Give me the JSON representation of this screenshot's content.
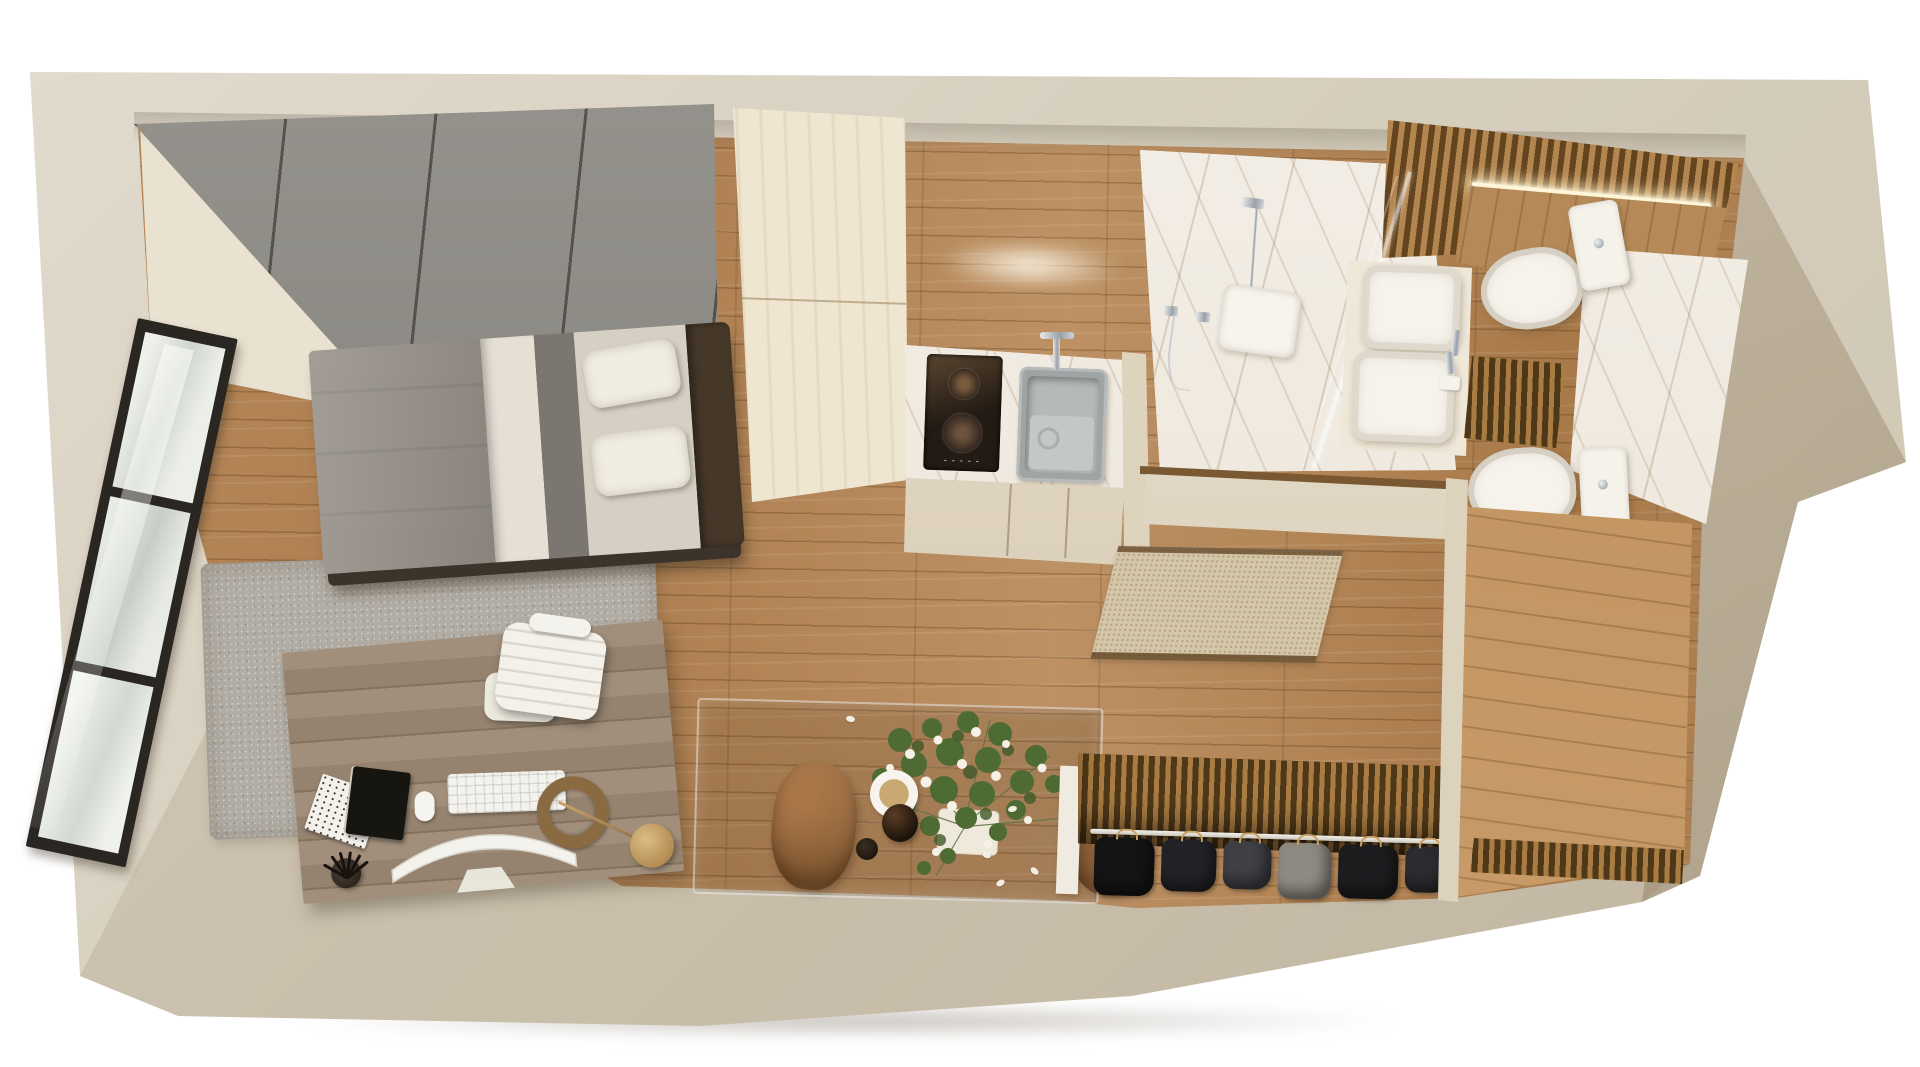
{
  "title": "Top-view 3D render of a studio apartment floor plan",
  "scene": {
    "type": "3d-floorplan-top-view",
    "apartment_label": "Studio apartment",
    "rooms": [
      {
        "name": "sleeping-work-area",
        "label": "Sleeping and work area",
        "items": [
          "grey wardrobe panels",
          "single bed with grey bedding",
          "area rug",
          "desk with computer, keyboard, notebooks, pens and lamp",
          "white office chair",
          "black-framed floor window"
        ]
      },
      {
        "name": "kitchenette",
        "label": "Kitchenette",
        "items": [
          "tall light-wood cabinet column",
          "two-zone induction hob",
          "grey square sink with chrome faucet",
          "marble countertop",
          "base cabinets",
          "under-cabinet light"
        ]
      },
      {
        "name": "hall-dining",
        "label": "Hall and dining corner",
        "items": [
          "glass dining table",
          "two tan chairs",
          "flower bouquet in white planter",
          "coffee mug",
          "dark bottle",
          "small cup",
          "entry doormat"
        ]
      },
      {
        "name": "bathroom",
        "label": "Bathroom",
        "items": [
          "marble walk-in shower",
          "ceiling rain shower",
          "hand shower",
          "glass partition",
          "square basin vanity",
          "two toilets (with mirror reflection)",
          "wood slat accent wall",
          "LED strip light"
        ]
      },
      {
        "name": "entry-closet",
        "label": "Open entry closet",
        "items": [
          "wood slat back panel",
          "hanging rail",
          "dark hanging clothes",
          "wood closet floor"
        ]
      }
    ],
    "labels": {
      "building": "Apartment outer walls",
      "floor": "Oak plank flooring",
      "window": "Black framed window",
      "wardrobe": "Built-in grey wardrobe",
      "bed": "Single bed",
      "headboard": "Dark wood headboard",
      "rug": "Grey area rug",
      "desk": "Wooden work desk",
      "imac": "All-in-one computer",
      "keyboard": "Keyboard",
      "mouse": "Mouse",
      "notebook_black": "Black notebook",
      "notebook_white": "Magazine",
      "pens": "Pen cup",
      "lamp": "Brass desk lamp",
      "desk_chair": "White office chair",
      "tall_cabinet": "Tall kitchen cabinet",
      "cooktop": "Induction hob",
      "sink": "Kitchen sink",
      "counter": "Marble counter",
      "cabinets": "Kitchen base cabinets",
      "glow": "Under-cabinet light",
      "shower_floor": "Marble shower area",
      "rain_shower": "Rain shower head",
      "hand_shower": "Hand shower",
      "glass_partition": "Glass shower partition",
      "slat_wall": "Wood slat accent wall",
      "led": "LED strip light",
      "wood_panel": "Wood wall panel",
      "marble_wall": "Marble wall",
      "vanity": "Bathroom vanity",
      "basin": "Square wash basin",
      "toilet": "Toilet",
      "slat_floor": "Slatted wood floor insert",
      "partition": "Bathroom partition wall",
      "threshold": "Wood threshold",
      "doormat": "Entry doormat",
      "table": "Glass dining table",
      "chair_tan_left": "Tan dining chair",
      "chair_tan_right": "Tan dining chair",
      "bouquet": "Flower bouquet",
      "mug": "Coffee mug",
      "bottle": "Dark bottle",
      "cup": "Small cup",
      "closet_back": "Closet slat back panel",
      "rail": "Clothes rail",
      "clothes": "Hanging clothes",
      "closet_floor": "Closet wood floor",
      "shadow": "Ground shadow"
    }
  },
  "palette": {
    "background": "#ffffff",
    "wall": "#d8d0bf",
    "wall_inner": "#eae2d0",
    "wall_shade": "#c0b49c",
    "floor_wood": "#b28155",
    "floor_wood_light": "#c79a66",
    "rug": "#b2ada4",
    "wardrobe": "#8f8c86",
    "bed_blanket": "#98928a",
    "bed_sheet": "#e5dfd4",
    "bed_stripe": "#7b766f",
    "pillow_zone": "#d6d0c4",
    "headboard": "#463829",
    "bed_base": "#3c342a",
    "desk_wood": "#9d8a75",
    "chair_white": "#f1efe8",
    "kitchen_column": "#efe6d1",
    "counter_marble": "#f1ece3",
    "cooktop": "#221a13",
    "sink": "#9fa4a4",
    "cabinet_face": "#e6dbc4",
    "bathroom_marble": "#f1ece3",
    "slat_wood": "#b3854f",
    "slat_gap": "#64441f",
    "led": "#fff6da",
    "fixture_white": "#f6f3ec",
    "chair_tan": "#a8713f",
    "greenery": "#54703b",
    "bloom": "#f5f1e6",
    "doormat": "#d4c7a9",
    "window_frame": "#2a2622",
    "clothes": [
      "#141416",
      "#232327",
      "#3f3f44",
      "#1d1d20",
      "#8e8a81",
      "#2c2c30"
    ]
  }
}
